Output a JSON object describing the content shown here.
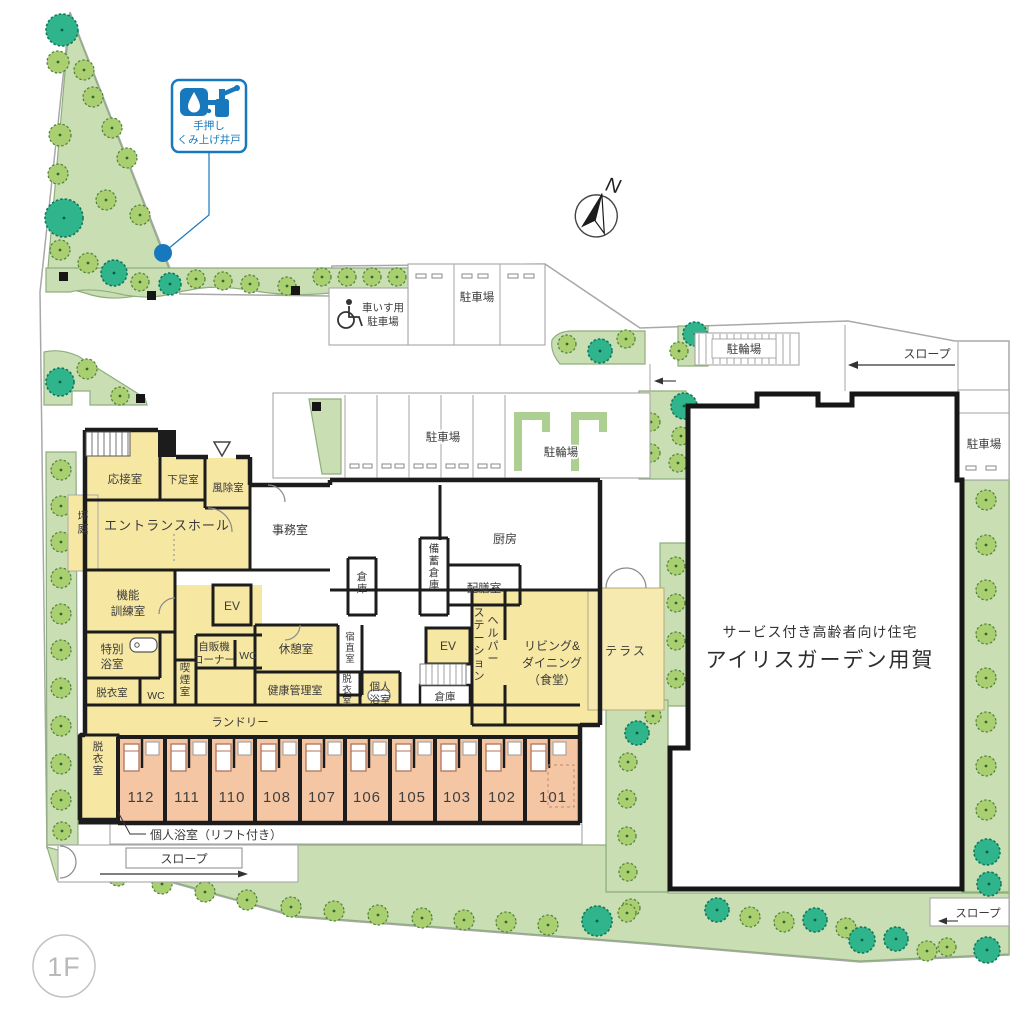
{
  "badge": {
    "label": "1F"
  },
  "compass": {
    "north": "N"
  },
  "well_sign": {
    "line1": "手押し",
    "line2": "くみ上げ井戸"
  },
  "site": {
    "parking_top": "駐車場",
    "parking_mid": "駐車場",
    "parking_right": "駐車場",
    "wheelchair_l1": "車いす用",
    "wheelchair_l2": "駐車場",
    "bicycle_mid": "駐輪場",
    "bicycle_top_right": "駐輪場",
    "slope_left": "スロープ",
    "slope_top_right": "スロープ",
    "slope_bottom_right": "スロープ"
  },
  "existing_building": {
    "line1": "サービス付き高齢者向け住宅",
    "line2": "アイリスガーデン用賀"
  },
  "rooms": {
    "reception": "応接室",
    "shoe_room": "下足室",
    "windbreak": "風除室",
    "tsubo_garden": "坪庭",
    "entrance_hall": "エントランスホール",
    "office": "事務室",
    "kitchen": "厨房",
    "stock_storage": "備蓄倉庫",
    "serving": "配膳室",
    "storage_small": "倉庫",
    "storage_mid": "倉庫",
    "training_l1": "機能",
    "training_l2": "訓練室",
    "special_bath_l1": "特別",
    "special_bath_l2": "浴室",
    "undress_left": "脱衣室",
    "wc": "WC",
    "ev": "EV",
    "vending_l1": "自販機",
    "vending_l2": "コーナー",
    "smoking": "喫煙室",
    "rest_room": "休憩室",
    "night_duty": "宿直室",
    "health_office": "健康管理室",
    "undress_mid": "脱衣室",
    "private_bath_l1": "個人",
    "private_bath_l2": "浴室",
    "laundry": "ランドリー",
    "helper_l1": "ヘルパー",
    "helper_l2": "ステーション",
    "living_l1": "リビング&",
    "living_l2": "ダイニング",
    "living_l3": "（食堂）",
    "terrace": "テラス",
    "undress_units": "脱衣室",
    "private_bath_lift": "個人浴室（リフト付き）"
  },
  "room_numbers": [
    "112",
    "111",
    "110",
    "108",
    "107",
    "106",
    "105",
    "103",
    "102",
    "101"
  ]
}
